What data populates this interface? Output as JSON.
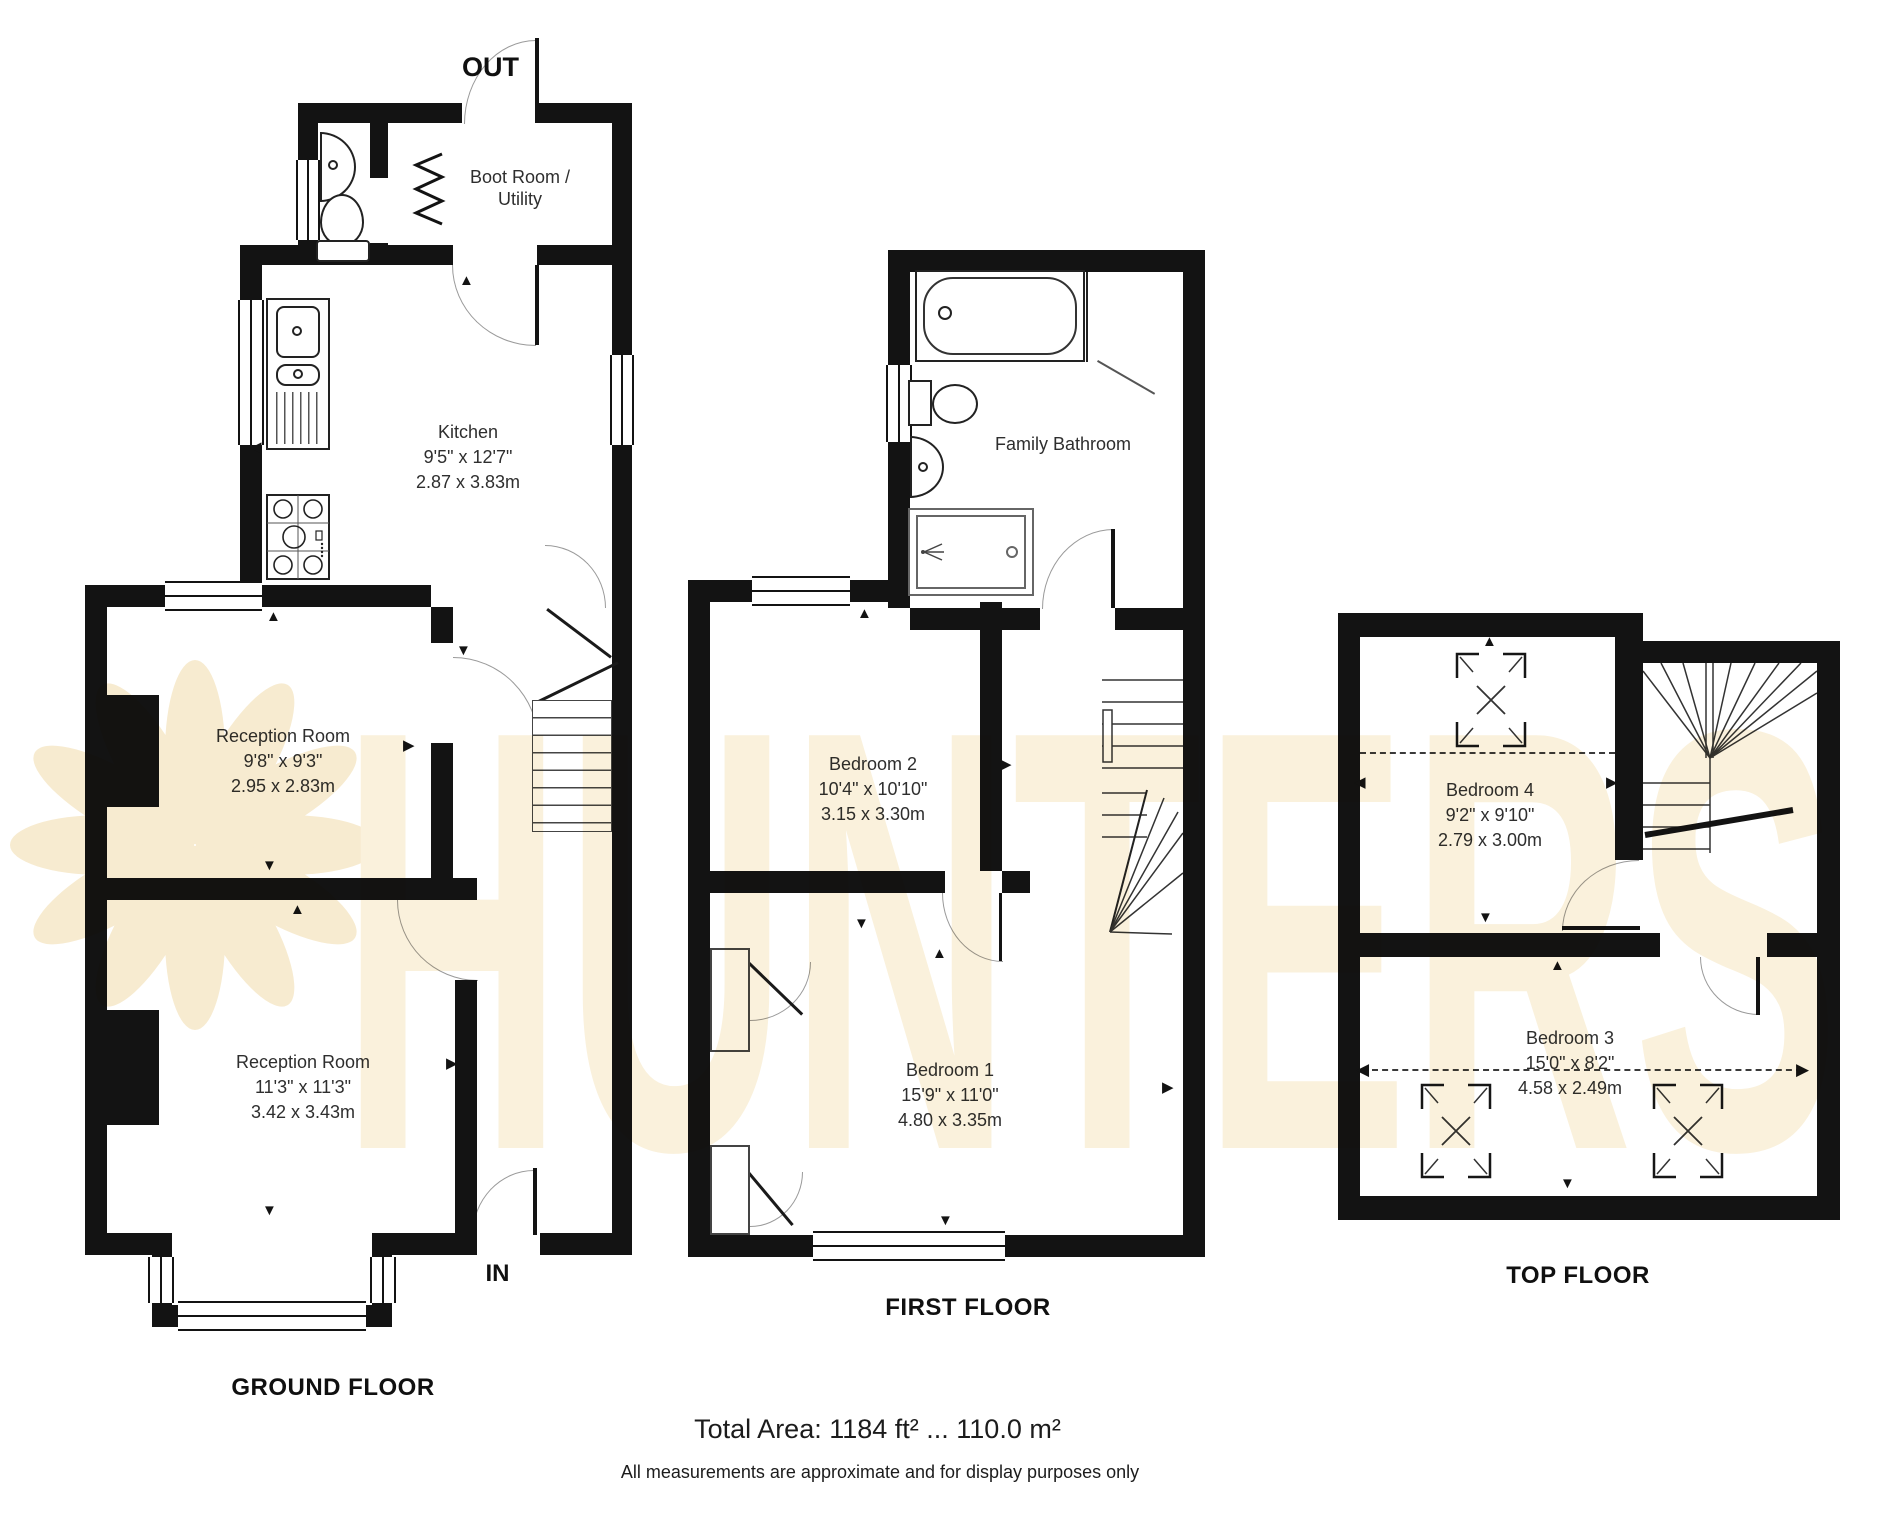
{
  "watermark": {
    "text": "HUNTERS",
    "color": "#F9EFD8"
  },
  "icons": {
    "arrow_up": "▲",
    "arrow_down": "▼",
    "arrow_left": "◀",
    "arrow_right": "▶"
  },
  "ground_floor": {
    "title": "GROUND FLOOR",
    "out_label": "OUT",
    "in_label": "IN",
    "boot_room": {
      "line1": "Boot Room /",
      "line2": "Utility"
    },
    "kitchen": {
      "name": "Kitchen",
      "imperial": "9'5\" x 12'7\"",
      "metric": "2.87 x 3.83m"
    },
    "reception1": {
      "name": "Reception Room",
      "imperial": "9'8\" x 9'3\"",
      "metric": "2.95 x 2.83m"
    },
    "reception2": {
      "name": "Reception Room",
      "imperial": "11'3\" x 11'3\"",
      "metric": "3.42 x 3.43m"
    }
  },
  "first_floor": {
    "title": "FIRST FLOOR",
    "bathroom": {
      "name": "Family Bathroom"
    },
    "bedroom2": {
      "name": "Bedroom 2",
      "imperial": "10'4\" x 10'10\"",
      "metric": "3.15 x 3.30m"
    },
    "bedroom1": {
      "name": "Bedroom 1",
      "imperial": "15'9\" x 11'0\"",
      "metric": "4.80 x 3.35m"
    }
  },
  "top_floor": {
    "title": "TOP FLOOR",
    "bedroom4": {
      "name": "Bedroom 4",
      "imperial": "9'2\" x 9'10\"",
      "metric": "2.79 x 3.00m"
    },
    "bedroom3": {
      "name": "Bedroom 3",
      "imperial": "15'0\" x 8'2\"",
      "metric": "4.58 x 2.49m"
    }
  },
  "footer": {
    "total_area": "Total Area: 1184 ft² ... 110.0 m²",
    "disclaimer": "All measurements are approximate and for display purposes only"
  }
}
